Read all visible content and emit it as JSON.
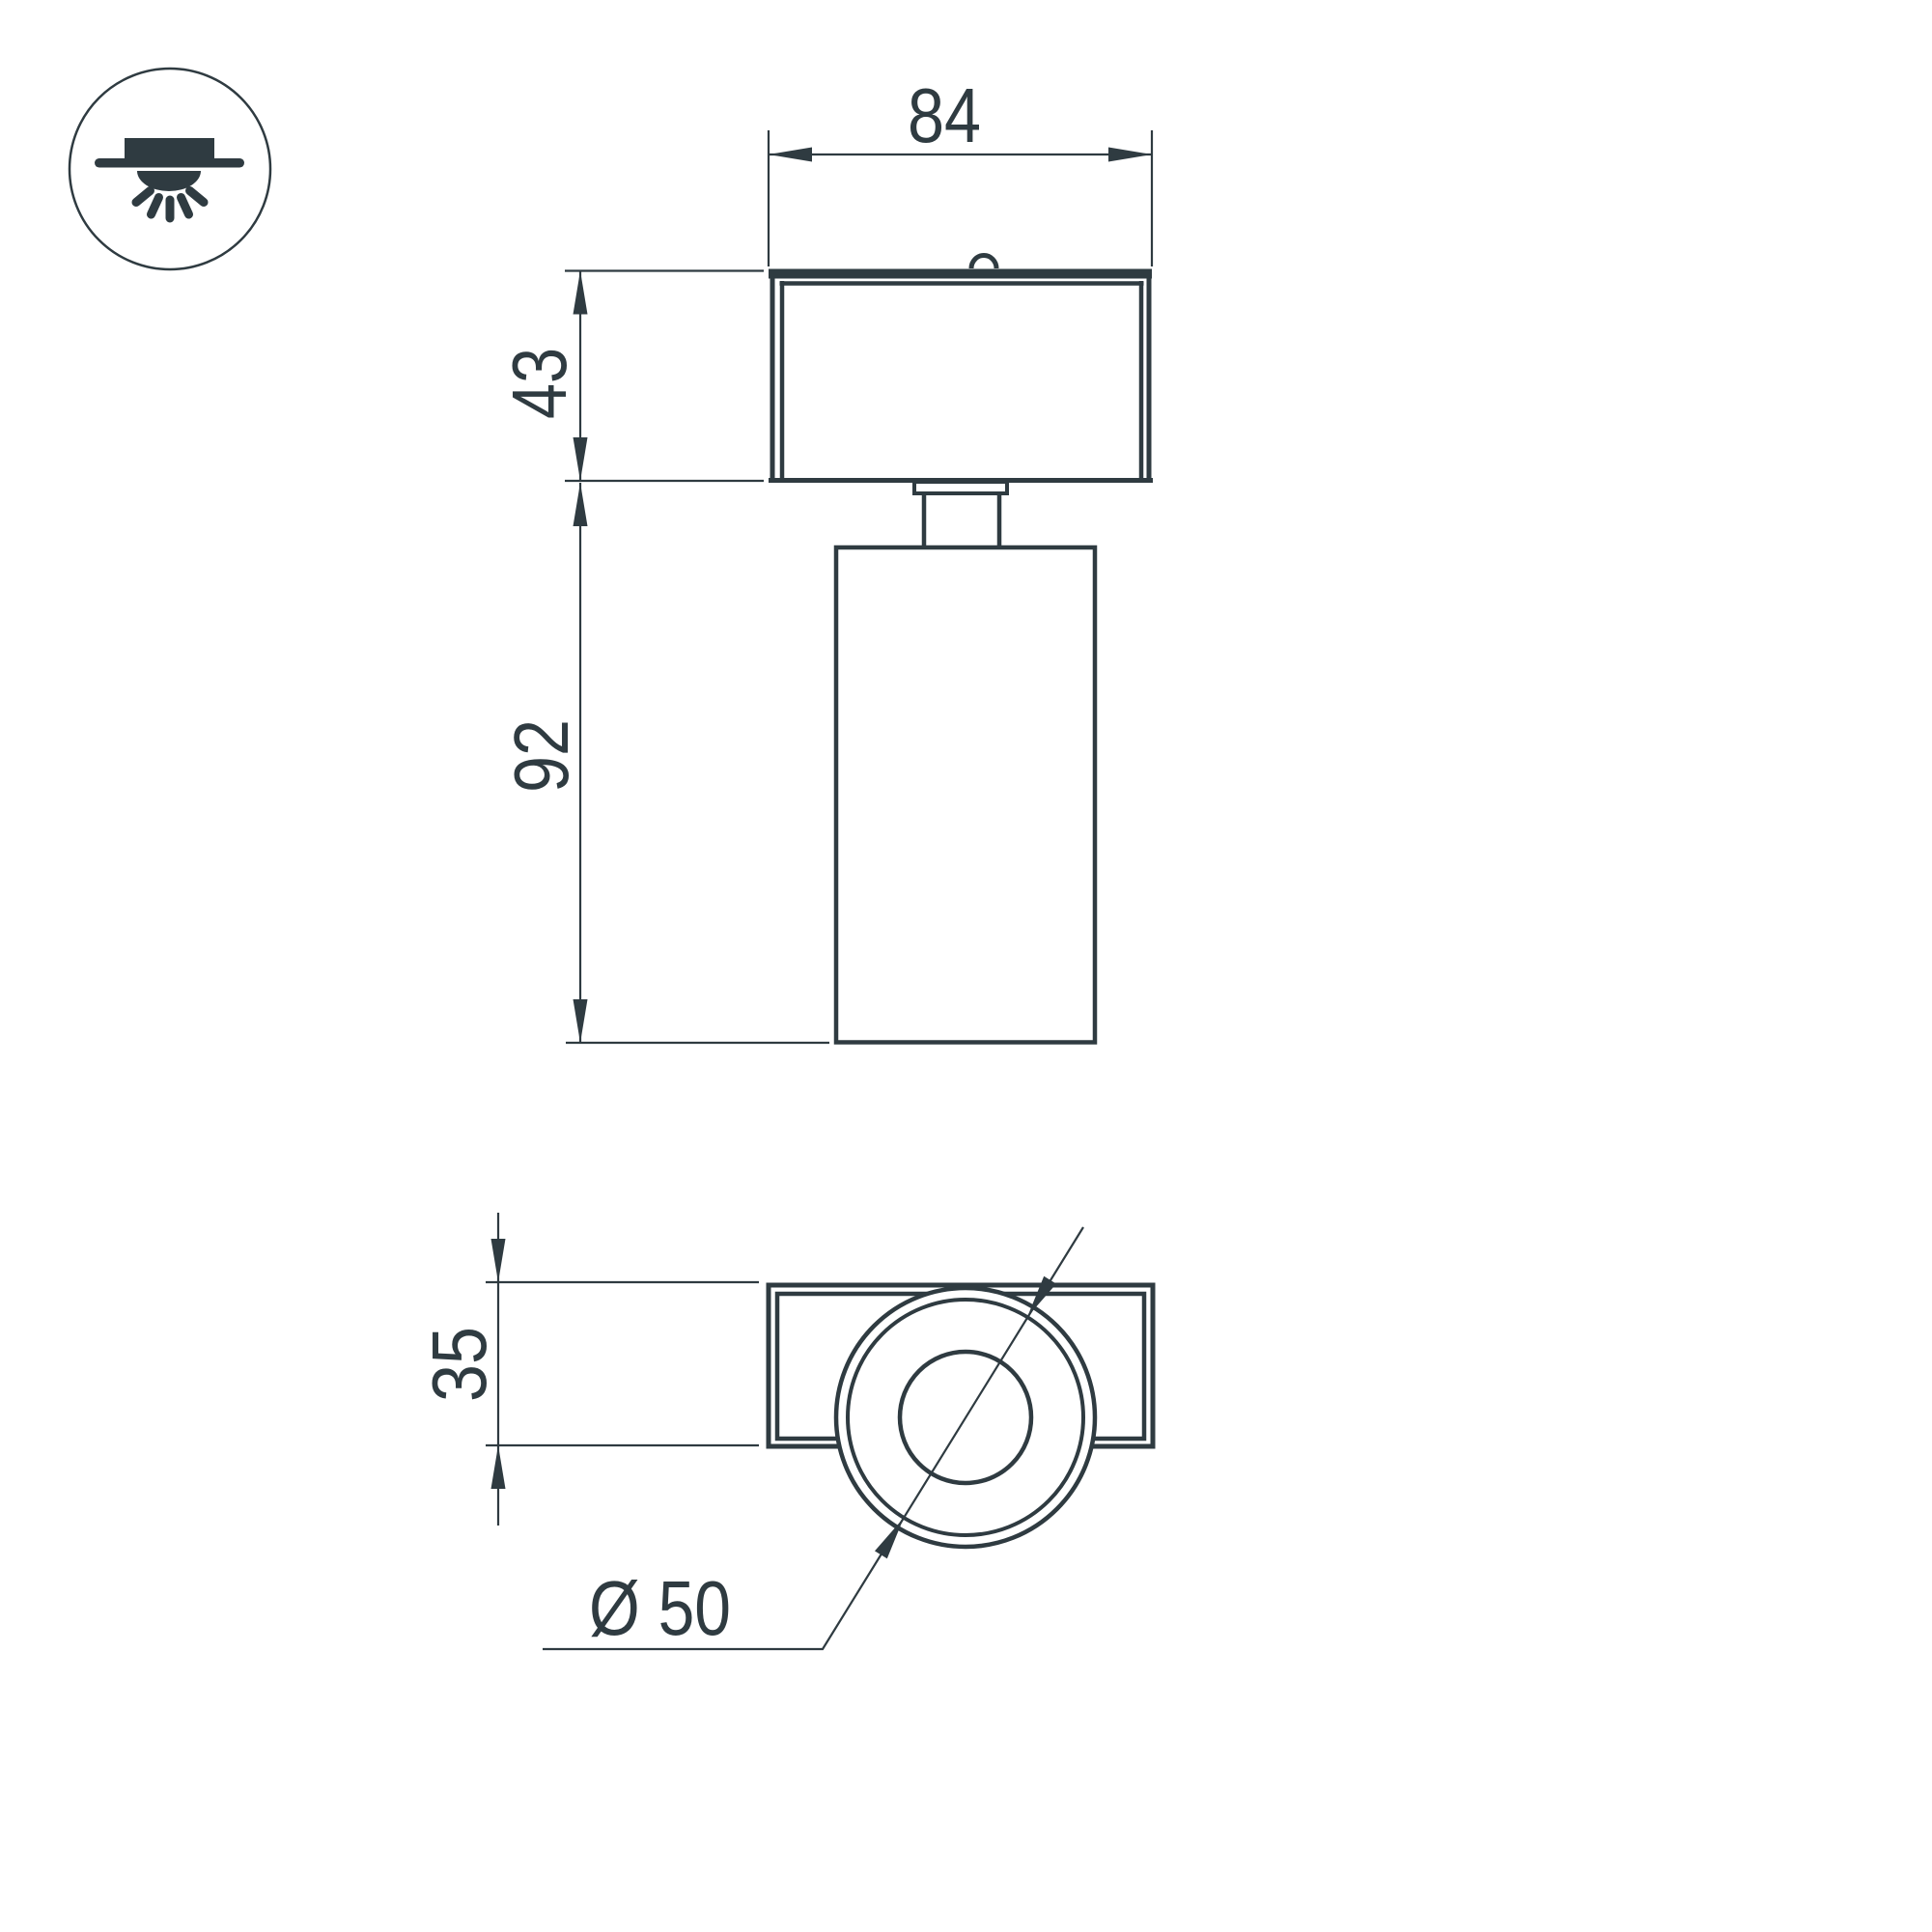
{
  "drawing": {
    "type": "technical-dimension-drawing",
    "subject": "surface-mounted spot luminaire, two orthographic views",
    "colors": {
      "line": "#2f3b41",
      "background": "#ffffff"
    },
    "icon": {
      "name": "ceiling-surface-light-icon"
    },
    "dimensions": {
      "width_top": "84",
      "housing_height": "43",
      "body_length": "92",
      "plate_height": "35",
      "diameter": "Ø 50"
    }
  }
}
